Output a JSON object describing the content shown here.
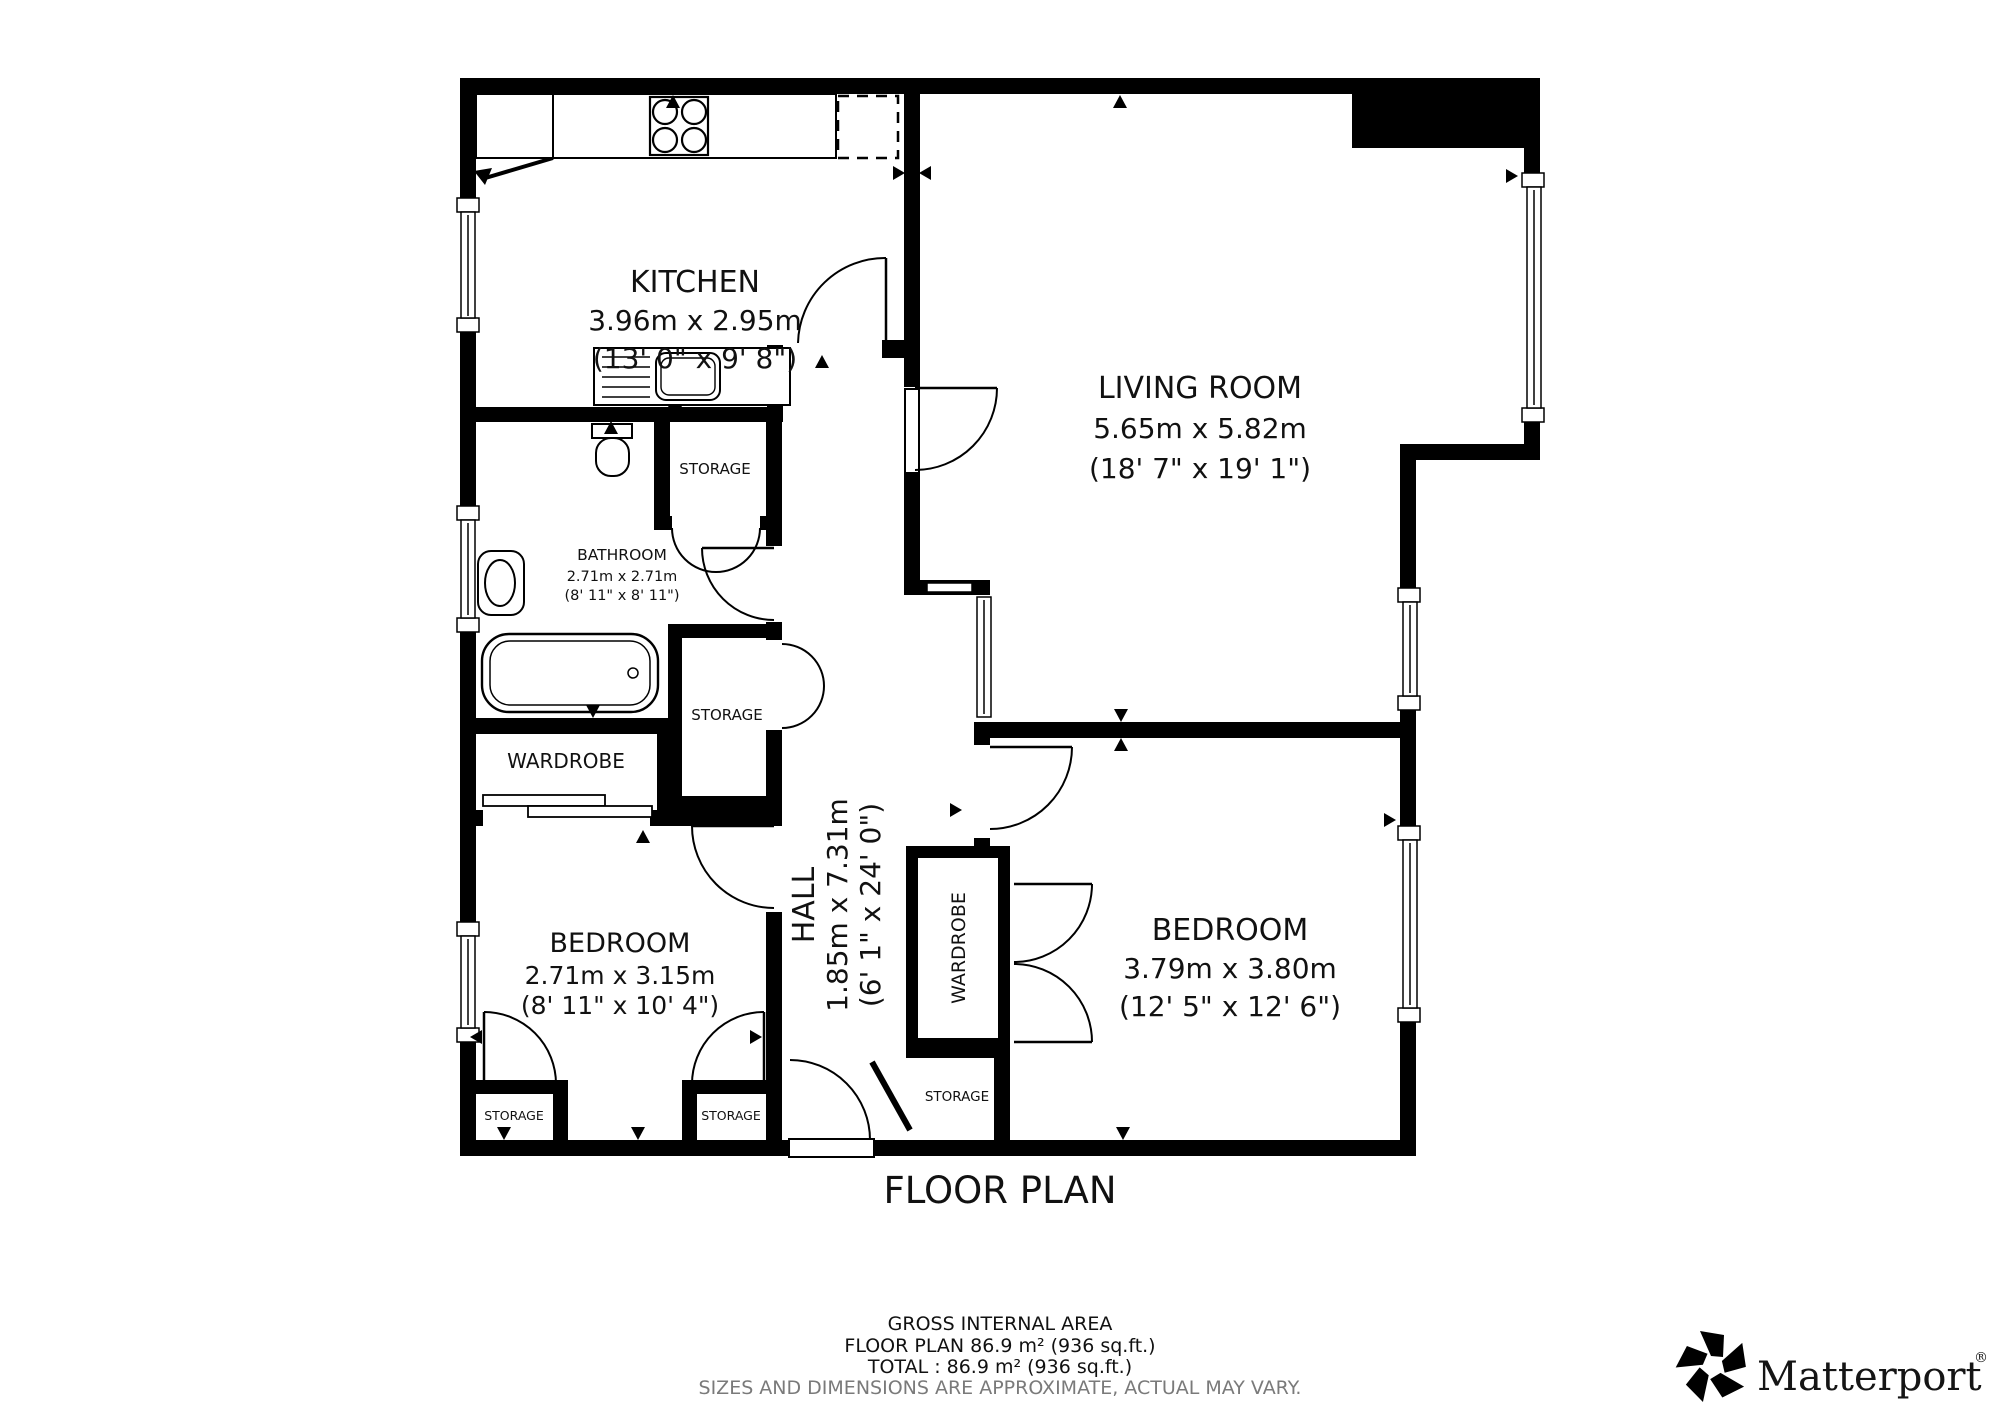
{
  "title": "FLOOR PLAN",
  "rooms": {
    "kitchen": {
      "name": "KITCHEN",
      "metric": "3.96m x 2.95m",
      "imperial": "(13' 0\" x 9' 8\")"
    },
    "living_room": {
      "name": "LIVING ROOM",
      "metric": "5.65m x 5.82m",
      "imperial": "(18' 7\" x 19' 1\")"
    },
    "bathroom": {
      "name": "BATHROOM",
      "metric": "2.71m x 2.71m",
      "imperial": "(8' 11\" x 8' 11\")"
    },
    "hall": {
      "name": "HALL",
      "metric": "1.85m x 7.31m",
      "imperial": "(6' 1\" x 24' 0\")"
    },
    "bedroom_small": {
      "name": "BEDROOM",
      "metric": "2.71m x 3.15m",
      "imperial": "(8' 11\" x 10' 4\")"
    },
    "bedroom_large": {
      "name": "BEDROOM",
      "metric": "3.79m x 3.80m",
      "imperial": "(12' 5\" x 12' 6\")"
    }
  },
  "closets": {
    "wardrobe_bathroom": "WARDROBE",
    "wardrobe_hall": "WARDROBE",
    "storage_bathroom_top": "STORAGE",
    "storage_bathroom_mid": "STORAGE",
    "storage_bedroom_left": "STORAGE",
    "storage_bedroom_right": "STORAGE",
    "storage_hall": "STORAGE"
  },
  "footer": {
    "gross": "GROSS INTERNAL AREA",
    "floor": "FLOOR PLAN 86.9 m² (936 sq.ft.)",
    "total": "TOTAL :  86.9 m² (936 sq.ft.)",
    "disclaimer": "SIZES AND DIMENSIONS ARE APPROXIMATE, ACTUAL MAY VARY."
  },
  "brand": {
    "name": "Matterport",
    "registered": "®"
  },
  "colors": {
    "wall": "#000000",
    "text": "#111111",
    "muted": "#7a7a7a"
  }
}
